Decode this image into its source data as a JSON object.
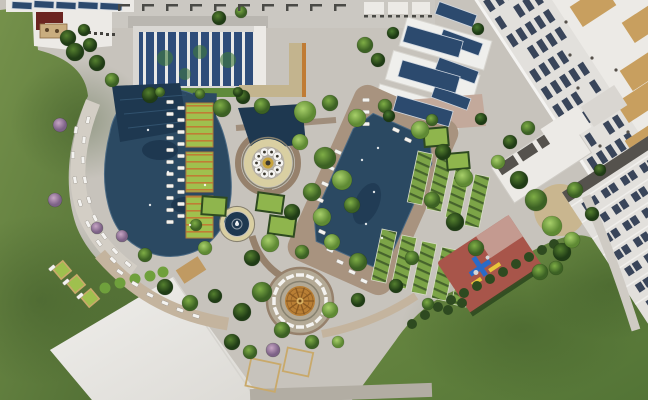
{
  "scene_meta": {
    "type": "aerial-architectural-rendering",
    "subject": "resort-courtyard-site-plan"
  },
  "palette": {
    "plaza": "#c7c3bc",
    "plaza_warm": "#beb3a4",
    "lawn_light": "#75914b",
    "lawn_mid": "#5d7c3a",
    "lawn_dark": "#4c6a31",
    "deck_tan": "#a8937f",
    "path_tan": "#c4b49e",
    "path_brown": "#96816c",
    "path_pink": "#c3a99b",
    "path_gray": "#cfcbc4",
    "pool": "#2b4962",
    "pool_dark": "#1e3850",
    "pool_edge": "#4b6a84",
    "roof_white": "#eceae6",
    "roof_gray": "#b9b6b0",
    "band_gray": "#cbc8c2",
    "glass_blue": "#2e4d7a",
    "mullion": "#e9e9e7",
    "window_dark": "#39455a",
    "facade": "#e2e0dc",
    "shadow": "#55524d",
    "roof_red": "#6b2420",
    "roof_tan_patch": "#c89f5f",
    "solar": "#2c4a6e",
    "playground_red": "#a8554a",
    "playground_pink": "#c49a90",
    "equip_blue": "#2a6bc8",
    "equip_yellow": "#e8c63a",
    "dome": "#b97f35",
    "dome_dark": "#8a5a22",
    "dome_light": "#d8b060",
    "ring_beige": "#d9cfa2",
    "ring_inner": "#b7b1a5",
    "gold": "#c8a43c",
    "lime": "#9fc04e",
    "pergola": "#c07c35",
    "cabana": "#7ca447",
    "cabana_dark": "#46632c",
    "hedge": "#2e4a20",
    "bush": "#6fa03c",
    "tree_light": "#8fbf56",
    "tree_mid": "#6fa03c",
    "tree_deep": "#35571f",
    "tree_pink": "#b493b4",
    "white": "#f4f3f0",
    "outline": "#87816f",
    "bracket": "#4a4a46",
    "planter_frame": "#c9a96a"
  },
  "scene": {
    "trees": [
      [
        68,
        38,
        8,
        "dark"
      ],
      [
        84,
        30,
        6,
        "dark"
      ],
      [
        75,
        52,
        9,
        "dark"
      ],
      [
        90,
        45,
        7,
        "dark"
      ],
      [
        97,
        63,
        8,
        "dark"
      ],
      [
        112,
        80,
        7,
        "mid"
      ],
      [
        60,
        125,
        7,
        "pink"
      ],
      [
        55,
        200,
        7,
        "pink"
      ],
      [
        97,
        228,
        6,
        "pink"
      ],
      [
        122,
        236,
        6,
        "pink"
      ],
      [
        150,
        95,
        8,
        "dark"
      ],
      [
        145,
        255,
        7,
        "mid"
      ],
      [
        165,
        287,
        8,
        "dark"
      ],
      [
        190,
        303,
        8,
        "mid"
      ],
      [
        215,
        296,
        7,
        "dark"
      ],
      [
        232,
        342,
        8,
        "dark"
      ],
      [
        250,
        352,
        7,
        "mid"
      ],
      [
        273,
        350,
        7,
        "pink"
      ],
      [
        222,
        108,
        9,
        "mid"
      ],
      [
        243,
        97,
        7,
        "dark"
      ],
      [
        262,
        106,
        8,
        "mid"
      ],
      [
        305,
        112,
        11,
        "light"
      ],
      [
        330,
        103,
        8,
        "mid"
      ],
      [
        357,
        118,
        9,
        "light"
      ],
      [
        385,
        106,
        7,
        "mid"
      ],
      [
        300,
        142,
        8,
        "light"
      ],
      [
        325,
        158,
        11,
        "mid"
      ],
      [
        342,
        180,
        10,
        "light"
      ],
      [
        312,
        192,
        9,
        "mid"
      ],
      [
        292,
        212,
        8,
        "dark"
      ],
      [
        322,
        217,
        9,
        "light"
      ],
      [
        352,
        205,
        8,
        "mid"
      ],
      [
        270,
        243,
        9,
        "light"
      ],
      [
        252,
        258,
        8,
        "dark"
      ],
      [
        302,
        252,
        7,
        "mid"
      ],
      [
        332,
        242,
        8,
        "light"
      ],
      [
        358,
        262,
        9,
        "mid"
      ],
      [
        262,
        292,
        10,
        "mid"
      ],
      [
        242,
        312,
        9,
        "dark"
      ],
      [
        282,
        330,
        8,
        "mid"
      ],
      [
        330,
        310,
        8,
        "light"
      ],
      [
        358,
        300,
        7,
        "dark"
      ],
      [
        312,
        342,
        7,
        "mid"
      ],
      [
        338,
        342,
        6,
        "light"
      ],
      [
        420,
        130,
        9,
        "light"
      ],
      [
        443,
        152,
        8,
        "dark"
      ],
      [
        464,
        178,
        9,
        "light"
      ],
      [
        432,
        200,
        8,
        "mid"
      ],
      [
        455,
        222,
        9,
        "dark"
      ],
      [
        476,
        248,
        8,
        "mid"
      ],
      [
        498,
        162,
        7,
        "light"
      ],
      [
        519,
        180,
        9,
        "dark"
      ],
      [
        536,
        200,
        11,
        "mid"
      ],
      [
        552,
        226,
        10,
        "light"
      ],
      [
        562,
        252,
        9,
        "dark"
      ],
      [
        540,
        272,
        8,
        "mid"
      ],
      [
        510,
        142,
        7,
        "dark"
      ],
      [
        528,
        128,
        7,
        "mid"
      ],
      [
        575,
        190,
        8,
        "mid"
      ],
      [
        592,
        214,
        7,
        "dark"
      ],
      [
        572,
        240,
        8,
        "light"
      ],
      [
        556,
        268,
        7,
        "mid"
      ],
      [
        600,
        170,
        6,
        "dark"
      ],
      [
        393,
        33,
        6,
        "palm"
      ],
      [
        478,
        29,
        6,
        "palm"
      ],
      [
        389,
        116,
        6,
        "palm"
      ],
      [
        481,
        119,
        6,
        "palm"
      ],
      [
        432,
        120,
        6,
        "mid"
      ],
      [
        412,
        258,
        7,
        "mid"
      ],
      [
        396,
        286,
        7,
        "dark"
      ],
      [
        428,
        304,
        6,
        "mid"
      ],
      [
        219,
        18,
        7,
        "dark"
      ],
      [
        241,
        12,
        6,
        "mid"
      ],
      [
        365,
        45,
        8,
        "mid"
      ],
      [
        378,
        60,
        7,
        "dark"
      ],
      [
        160,
        92,
        5,
        "mid"
      ],
      [
        200,
        94,
        5,
        "mid"
      ],
      [
        238,
        92,
        5,
        "dark"
      ],
      [
        205,
        248,
        7,
        "light"
      ],
      [
        196,
        225,
        6,
        "mid"
      ]
    ],
    "chairs": [
      [
        88,
        120,
        -78
      ],
      [
        84,
        140,
        -85
      ],
      [
        83,
        160,
        -92
      ],
      [
        85,
        180,
        -100
      ],
      [
        89,
        200,
        -108
      ],
      [
        95,
        218,
        -116
      ],
      [
        104,
        236,
        -125
      ],
      [
        115,
        251,
        -133
      ],
      [
        128,
        264,
        -140
      ],
      [
        76,
        130,
        -82
      ],
      [
        73,
        155,
        -90
      ],
      [
        75,
        180,
        -99
      ],
      [
        80,
        203,
        -108
      ],
      [
        88,
        224,
        -117
      ],
      [
        99,
        243,
        -127
      ],
      [
        113,
        260,
        -136
      ],
      [
        170,
        102,
        0
      ],
      [
        170,
        114,
        0
      ],
      [
        170,
        126,
        0
      ],
      [
        170,
        138,
        0
      ],
      [
        170,
        150,
        0
      ],
      [
        170,
        162,
        0
      ],
      [
        170,
        174,
        0
      ],
      [
        170,
        186,
        0
      ],
      [
        170,
        198,
        0
      ],
      [
        170,
        210,
        0
      ],
      [
        170,
        222,
        0
      ],
      [
        181,
        108,
        0
      ],
      [
        181,
        120,
        0
      ],
      [
        181,
        132,
        0
      ],
      [
        181,
        144,
        0
      ],
      [
        181,
        156,
        0
      ],
      [
        181,
        168,
        0
      ],
      [
        181,
        180,
        0
      ],
      [
        181,
        192,
        0
      ],
      [
        181,
        204,
        0
      ],
      [
        181,
        216,
        0
      ],
      [
        366,
        100,
        0
      ],
      [
        366,
        112,
        0
      ],
      [
        366,
        124,
        0
      ],
      [
        338,
        152,
        24
      ],
      [
        331,
        168,
        24
      ],
      [
        325,
        184,
        24
      ],
      [
        320,
        200,
        24
      ],
      [
        317,
        216,
        24
      ],
      [
        322,
        232,
        24
      ],
      [
        330,
        250,
        24
      ],
      [
        340,
        262,
        24
      ],
      [
        352,
        272,
        24
      ],
      [
        364,
        281,
        24
      ],
      [
        396,
        130,
        24
      ],
      [
        408,
        140,
        24
      ],
      [
        120,
        272,
        35
      ],
      [
        135,
        284,
        30
      ],
      [
        150,
        295,
        26
      ],
      [
        165,
        303,
        22
      ],
      [
        180,
        310,
        20
      ],
      [
        196,
        316,
        18
      ],
      [
        52,
        268,
        -40
      ],
      [
        66,
        282,
        -40
      ],
      [
        80,
        296,
        -40
      ]
    ],
    "cabana_rows": [
      [
        420,
        178,
        12
      ],
      [
        439,
        185,
        12
      ],
      [
        458,
        193,
        12
      ],
      [
        477,
        201,
        12
      ],
      [
        384,
        256,
        12
      ],
      [
        404,
        262,
        12
      ],
      [
        424,
        268,
        12
      ],
      [
        444,
        274,
        12
      ],
      [
        464,
        280,
        12
      ]
    ],
    "hedge_dots": [
      [
        412,
        324
      ],
      [
        425,
        315
      ],
      [
        438,
        307
      ],
      [
        451,
        300
      ],
      [
        464,
        293
      ],
      [
        477,
        286
      ],
      [
        490,
        279
      ],
      [
        503,
        272
      ],
      [
        516,
        264
      ],
      [
        529,
        257
      ],
      [
        542,
        250
      ],
      [
        554,
        244
      ],
      [
        448,
        310
      ],
      [
        462,
        303
      ]
    ],
    "bushes": [
      [
        105,
        288
      ],
      [
        120,
        283
      ],
      [
        135,
        279
      ],
      [
        150,
        276
      ],
      [
        163,
        272
      ]
    ],
    "planter_squares": [
      [
        62,
        270,
        -40
      ],
      [
        76,
        284,
        -40
      ],
      [
        90,
        298,
        -40
      ]
    ],
    "lawn_squares": [
      [
        263,
        375,
        30,
        28,
        12
      ],
      [
        298,
        362,
        26,
        24,
        12
      ]
    ],
    "garden_beds": [
      [
        270,
        203,
        26,
        18,
        8
      ],
      [
        282,
        226,
        26,
        18,
        8
      ],
      [
        436,
        137,
        24,
        18,
        -5
      ],
      [
        458,
        161,
        22,
        16,
        -5
      ],
      [
        214,
        206,
        24,
        18,
        4
      ]
    ],
    "pergola_beds": [
      [
        186,
        103,
        27,
        44
      ],
      [
        186,
        152,
        27,
        40
      ],
      [
        186,
        196,
        27,
        42
      ]
    ],
    "solar_panels": [
      [
        436,
        8,
        40,
        13,
        20
      ],
      [
        440,
        36,
        42,
        13,
        20
      ],
      [
        436,
        64,
        42,
        13,
        20
      ],
      [
        432,
        92,
        38,
        12,
        20
      ],
      [
        404,
        33,
        58,
        17,
        16
      ],
      [
        399,
        68,
        60,
        17,
        16
      ],
      [
        394,
        103,
        58,
        16,
        16
      ],
      [
        12,
        2,
        20,
        7,
        3
      ],
      [
        34,
        1,
        20,
        7,
        3
      ],
      [
        56,
        2,
        20,
        7,
        3
      ],
      [
        78,
        2,
        20,
        7,
        3
      ],
      [
        100,
        3,
        22,
        7,
        3
      ]
    ],
    "tan_patches": [
      [
        593,
        6
      ],
      [
        645,
        22
      ],
      [
        643,
        70
      ],
      [
        639,
        102
      ],
      [
        648,
        140
      ]
    ],
    "roof_dots": [
      [
        566,
        22
      ],
      [
        592,
        58
      ],
      [
        578,
        88
      ],
      [
        610,
        100
      ],
      [
        628,
        132
      ],
      [
        600,
        146
      ],
      [
        570,
        55
      ],
      [
        616,
        70
      ],
      [
        640,
        160
      ],
      [
        586,
        120
      ]
    ],
    "tl_window_dots": [
      [
        88,
        31
      ],
      [
        94,
        32
      ],
      [
        100,
        32
      ],
      [
        106,
        33
      ],
      [
        112,
        33
      ]
    ],
    "water_sparkles": [
      [
        148,
        130
      ],
      [
        168,
        172
      ],
      [
        150,
        205
      ],
      [
        190,
        225
      ],
      [
        205,
        185
      ],
      [
        362,
        160
      ],
      [
        374,
        192
      ],
      [
        366,
        224
      ],
      [
        382,
        238
      ],
      [
        378,
        148
      ],
      [
        237,
        222
      ]
    ],
    "parapet_rows": [
      {
        "y": 4,
        "x0": 118,
        "x1": 356,
        "step": 24,
        "kind": "bracket"
      },
      {
        "y": 15,
        "x0": 364,
        "x1": 430,
        "step": 8,
        "kind": "tick"
      }
    ],
    "facade_top": {
      "rows": 5,
      "row_y0": -54,
      "row_step": 11,
      "col_x0": 482,
      "cols": 16,
      "col_step": 21,
      "win_w": 13,
      "win_h": 6.5
    },
    "facade_grid": {
      "rows": 7,
      "row_y0": 170,
      "row_step": 19.5,
      "col_x0": 616,
      "cols": 6,
      "col_step": 23,
      "win_w": 7,
      "win_h": 9
    },
    "ring_tables": {
      "cx": 268,
      "cy": 163,
      "count": 10,
      "radius": 11.5,
      "r": 4.2
    },
    "radial_benches": {
      "cx": 300,
      "cy": 301,
      "count": 16,
      "radius": 26,
      "w": 8,
      "h": 3.5
    },
    "dome_spokes": {
      "cx": 300,
      "cy": 301,
      "count": 10,
      "r0": 3,
      "r1": 14
    }
  }
}
